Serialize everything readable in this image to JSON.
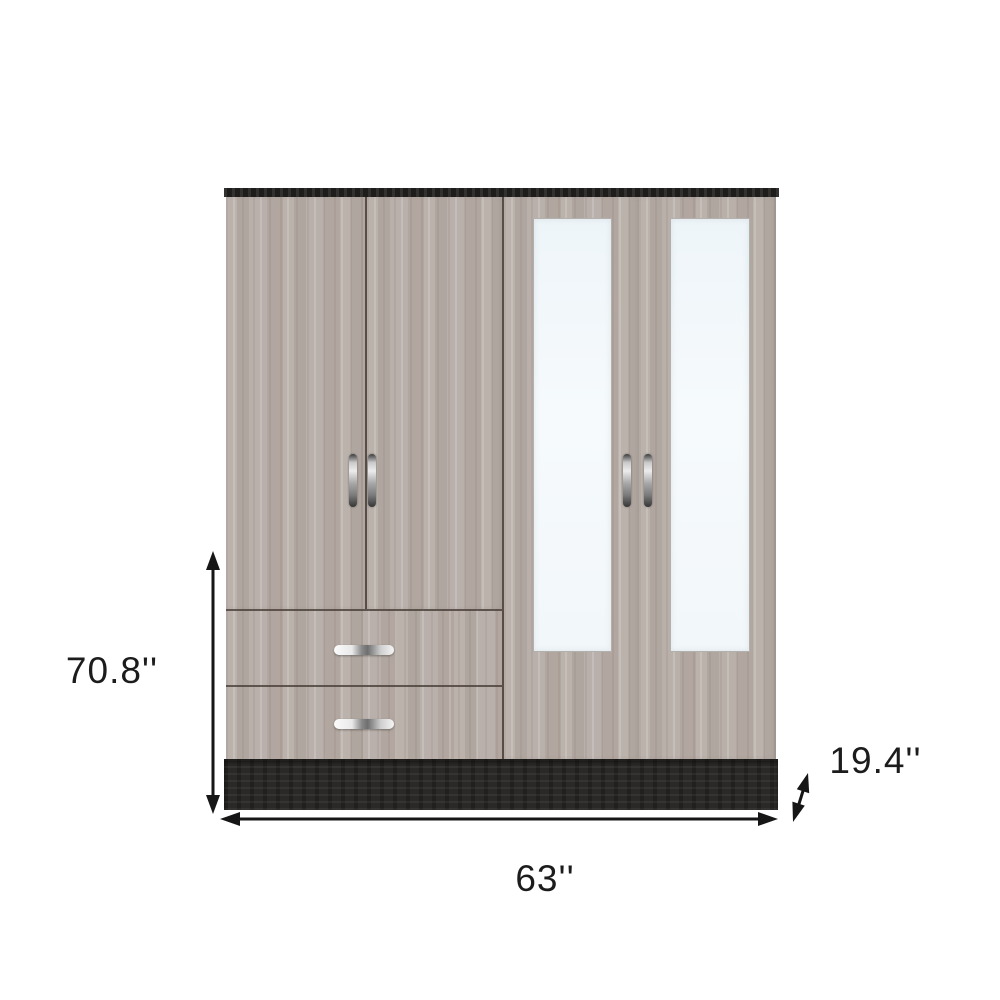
{
  "diagram": {
    "dimensions": {
      "height": {
        "label": "70.8''"
      },
      "width": {
        "label": "63''"
      },
      "depth": {
        "label": "19.4''"
      }
    },
    "icons": {
      "height_arrow": "double-headed-vertical-arrow",
      "width_arrow": "double-headed-horizontal-arrow",
      "depth_arrow": "double-headed-diagonal-arrow"
    },
    "colors": {
      "background": "#ffffff",
      "wood": "#b6aca6",
      "trim_black": "#262422",
      "base_black": "#2b2927",
      "mirror": "#f3f8fb",
      "handle_silver": "#c9c9c9",
      "dimension_line": "#161616"
    }
  }
}
